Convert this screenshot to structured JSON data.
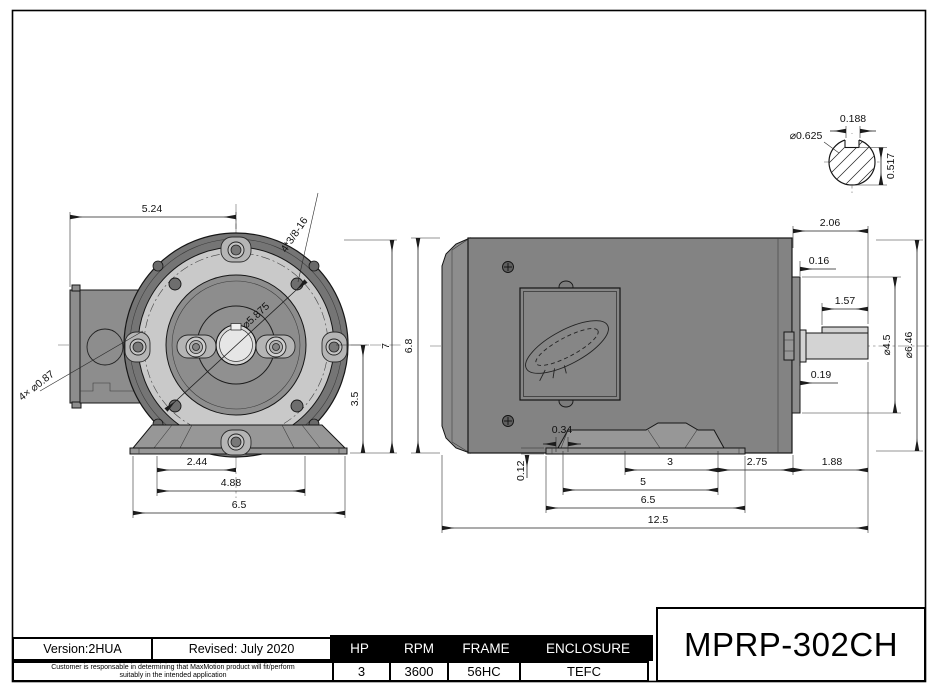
{
  "colors": {
    "metal_dark": "#757575",
    "metal_mid": "#8d8d8d",
    "metal_light": "#c9c9c9",
    "metal_boss": "#b5b5b5",
    "metal_shaft": "#d3d3d3",
    "metal_base": "#979797",
    "line": "#1c1c1c"
  },
  "front_view": {
    "dims": {
      "width": "5.24",
      "tap_holes": "4*3/8-16",
      "bolt_circle": "⌀5.875",
      "conduit_knockouts": "4× ⌀0.87",
      "overall_height": "7",
      "shaft_center_height": "3.5",
      "foot_bolt_half_span": "2.44",
      "foot_bolt_span": "4.88",
      "base_width": "6.5"
    }
  },
  "side_view": {
    "dims": {
      "body_height": "6.8",
      "shaft_extension": "2.06",
      "face_plate_thickness": "0.16",
      "key_flat_length": "1.57",
      "pilot_diameter": "⌀4.5",
      "body_diameter": "⌀6.46",
      "shaft_shoulder": "0.19",
      "foot_offset": "0.34",
      "base_plate_thickness": "0.12",
      "foot_bolt_span": "3",
      "foot_bolt_length_span": "5",
      "base_length": "6.5",
      "face_overhang": "2.75",
      "shaft_length": "1.88",
      "overall_length": "12.5"
    }
  },
  "shaft_detail": {
    "dims": {
      "key_width": "0.188",
      "shaft_diameter": "⌀0.625",
      "flat_height": "0.517"
    }
  },
  "title_block": {
    "version": "Version:2HUA",
    "revised": "Revised: July 2020",
    "disclaimer_line1": "Customer is responsable in determining that MaxMotion product will fit/perform",
    "disclaimer_line2": "suitably in the intended application",
    "spec_columns": [
      {
        "label": "HP",
        "value": "3"
      },
      {
        "label": "RPM",
        "value": "3600"
      },
      {
        "label": "FRAME",
        "value": "56HC"
      },
      {
        "label": "ENCLOSURE",
        "value": "TEFC"
      }
    ],
    "model_number": "MPRP-302CH"
  }
}
